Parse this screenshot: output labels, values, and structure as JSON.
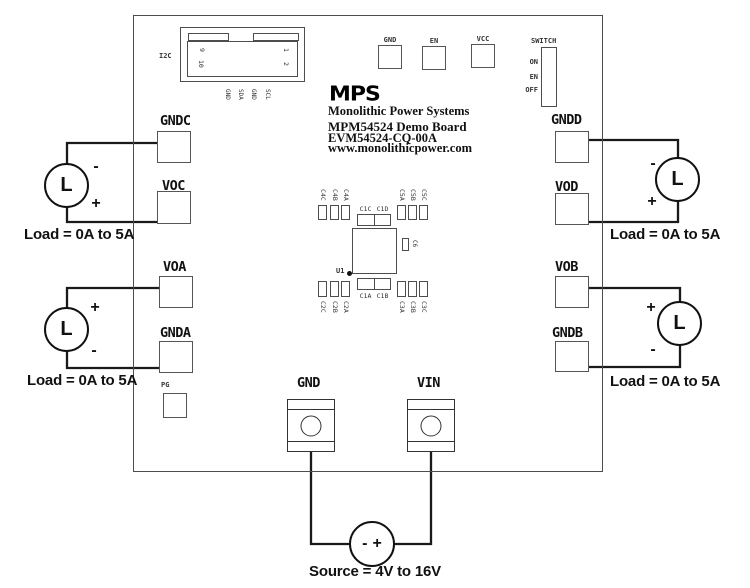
{
  "i2c": {
    "label": "I2C",
    "pin_numbers": [
      "9",
      "10",
      "1",
      "2"
    ],
    "pin_names": [
      "GND",
      "SDA",
      "GND",
      "SCL"
    ]
  },
  "top_pads": {
    "gnd": "GND",
    "en": "EN",
    "vcc": "VCC"
  },
  "switch": {
    "label": "SWITCH",
    "positions": [
      "ON",
      "EN",
      "OFF"
    ]
  },
  "branding": {
    "logo": "MPS",
    "company": "Monolithic Power Systems",
    "board_name": "MPM54524 Demo Board",
    "board_rev": "EVM54524-CQ-00A",
    "website": "www.monolithicpower.com"
  },
  "components": {
    "ic": "U1",
    "side_cap": "C6",
    "top_left": [
      "C4C",
      "C4B",
      "C4A"
    ],
    "top_center": [
      "C1C",
      "C1D"
    ],
    "top_right": [
      "C5A",
      "C5B",
      "C5C"
    ],
    "bottom_left": [
      "C2C",
      "C2B",
      "C2A"
    ],
    "bottom_center": [
      "C1A",
      "C1B"
    ],
    "bottom_right": [
      "C3A",
      "C3B",
      "C3C"
    ]
  },
  "terminals": {
    "left": [
      "GNDC",
      "VOC",
      "VOA",
      "GNDA"
    ],
    "right": [
      "GNDD",
      "VOD",
      "VOB",
      "GNDB"
    ],
    "bottom": [
      "GND",
      "VIN"
    ],
    "pg": "PG"
  },
  "loads": {
    "symbol": "L",
    "label": "Load = 0A to 5A",
    "top_left": {
      "top_sign": "-",
      "bottom_sign": "+"
    },
    "bottom_left": {
      "top_sign": "+",
      "bottom_sign": "-"
    },
    "top_right": {
      "top_sign": "-",
      "bottom_sign": "+"
    },
    "bottom_right": {
      "top_sign": "+",
      "bottom_sign": "-"
    }
  },
  "source": {
    "neg": "-",
    "pos": "+",
    "label": "Source = 4V to 16V"
  },
  "colors": {
    "wire": "#1a1a1a",
    "silkscreen": "#4d4d4d",
    "text": "#111111",
    "background": "#ffffff"
  }
}
